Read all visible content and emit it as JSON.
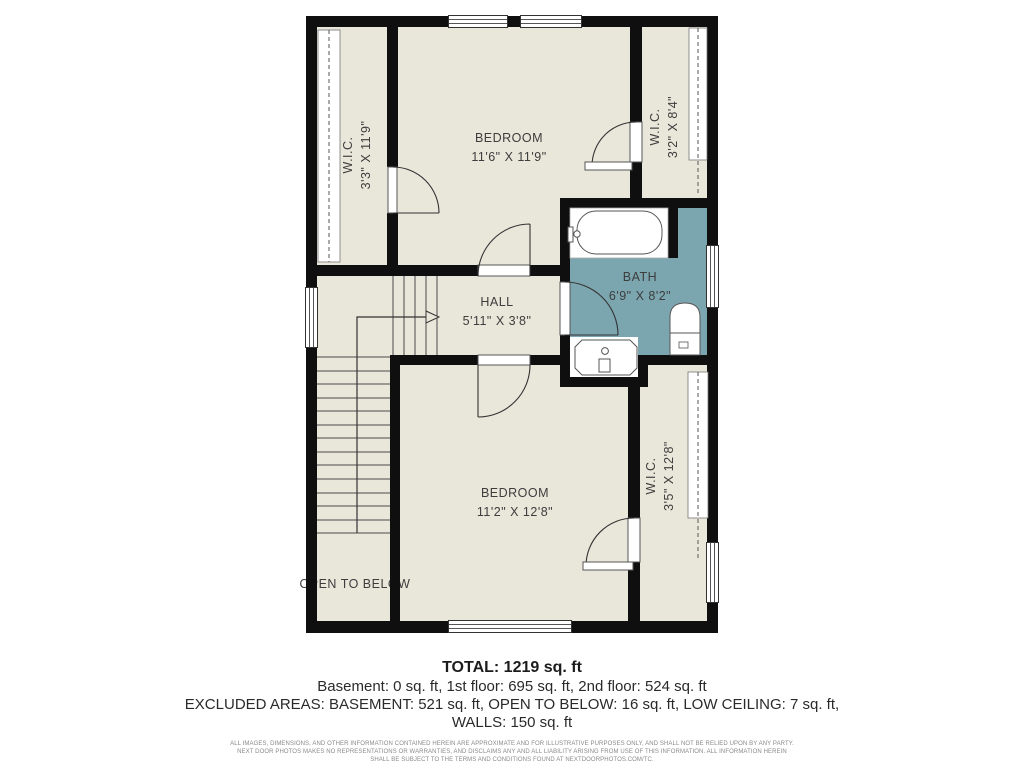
{
  "plan": {
    "rooms": [
      {
        "name": "W.I.C.",
        "dims": "3'3\" X 11'9\""
      },
      {
        "name": "BEDROOM",
        "dims": "11'6\" X 11'9\""
      },
      {
        "name": "W.I.C.",
        "dims": "3'2\" X 8'4\""
      },
      {
        "name": "BATH",
        "dims": "6'9\" X 8'2\""
      },
      {
        "name": "HALL",
        "dims": "5'11\" X 3'8\""
      },
      {
        "name": "BEDROOM",
        "dims": "11'2\" X 12'8\""
      },
      {
        "name": "W.I.C.",
        "dims": "3'5\" X 12'8\""
      }
    ],
    "open_to_below": "OPEN TO BELOW",
    "colors": {
      "floor": "#E9E6DA",
      "bath_floor": "#7CA6AF",
      "wall": "#0F0F0F"
    }
  },
  "summary": {
    "total": "TOTAL: 1219 sq. ft",
    "floors": "Basement: 0 sq. ft, 1st floor: 695 sq. ft, 2nd floor: 524 sq. ft",
    "excluded_line1": "EXCLUDED AREAS: BASEMENT: 521 sq. ft, OPEN TO BELOW: 16 sq. ft, LOW CEILING: 7 sq. ft,",
    "excluded_line2": "WALLS: 150 sq. ft"
  },
  "disclaimer": {
    "line1": "ALL IMAGES, DIMENSIONS, AND OTHER INFORMATION CONTAINED HEREIN ARE APPROXIMATE AND FOR ILLUSTRATIVE PURPOSES ONLY, AND SHALL NOT BE RELIED UPON BY ANY PARTY.",
    "line2": "NEXT DOOR PHOTOS MAKES NO REPRESENTATIONS OR WARRANTIES, AND DISCLAIMS ANY AND ALL LIABILITY ARISING FROM USE OF THIS INFORMATION. ALL INFORMATION HEREIN",
    "line3": "SHALL BE SUBJECT TO THE TERMS AND CONDITIONS FOUND AT NEXTDOORPHOTOS.COM/TC."
  }
}
